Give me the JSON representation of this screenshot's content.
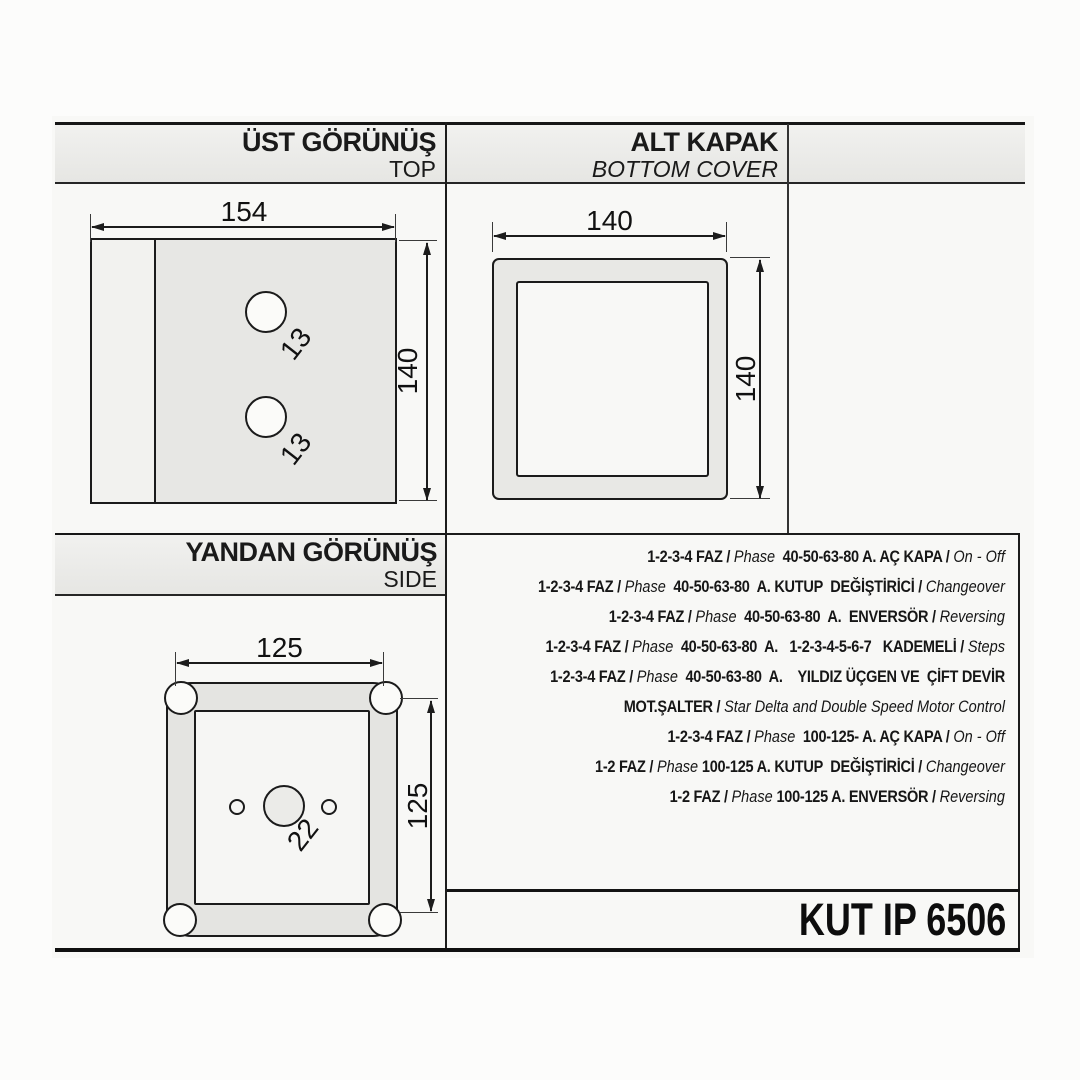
{
  "colors": {
    "ink": "#1c1c1c",
    "paper": "#f8f8f6",
    "band_fill": "#e9e9e6"
  },
  "top_view": {
    "title": "ÜST GÖRÜNÜŞ",
    "subtitle": "TOP",
    "width_dim": "154",
    "height_dim": "140",
    "hole_top_dim": "13",
    "hole_bottom_dim": "13"
  },
  "bottom_cover": {
    "title": "ALT KAPAK",
    "subtitle": "BOTTOM COVER",
    "width_dim": "140",
    "height_dim": "140"
  },
  "side_view": {
    "title": "YANDAN GÖRÜNÜŞ",
    "subtitle": "SIDE",
    "width_dim": "125",
    "height_dim": "125",
    "hole_dim": "22"
  },
  "spec_lines": [
    [
      {
        "t": "1-2-3-4 FAZ / ",
        "s": "b"
      },
      {
        "t": "Phase",
        "s": "i"
      },
      {
        "t": "  40-50-63-80 A. AÇ KAPA / ",
        "s": "b"
      },
      {
        "t": "On - Off",
        "s": "i"
      }
    ],
    [
      {
        "t": "1-2-3-4 FAZ / ",
        "s": "b"
      },
      {
        "t": "Phase",
        "s": "i"
      },
      {
        "t": "  40-50-63-80  A. KUTUP  DEĞİŞTİRİCİ / ",
        "s": "b"
      },
      {
        "t": "Changeover",
        "s": "i"
      }
    ],
    [
      {
        "t": "1-2-3-4 FAZ / ",
        "s": "b"
      },
      {
        "t": "Phase",
        "s": "i"
      },
      {
        "t": "  40-50-63-80  A.  ENVERSÖR / ",
        "s": "b"
      },
      {
        "t": "Reversing",
        "s": "i"
      }
    ],
    [
      {
        "t": "1-2-3-4 FAZ / ",
        "s": "b"
      },
      {
        "t": "Phase",
        "s": "i"
      },
      {
        "t": "  40-50-63-80  A.   1-2-3-4-5-6-7   KADEMELİ / ",
        "s": "b"
      },
      {
        "t": "Steps",
        "s": "i"
      }
    ],
    [
      {
        "t": "1-2-3-4 FAZ / ",
        "s": "b"
      },
      {
        "t": "Phase",
        "s": "i"
      },
      {
        "t": "  40-50-63-80  A.    YILDIZ ÜÇGEN VE  ÇİFT DEVİR",
        "s": "b"
      }
    ],
    [
      {
        "t": "MOT.ŞALTER / ",
        "s": "b"
      },
      {
        "t": "Star Delta and Double Speed Motor Control",
        "s": "i"
      }
    ],
    [
      {
        "t": "1-2-3-4 FAZ / ",
        "s": "b"
      },
      {
        "t": "Phase",
        "s": "i"
      },
      {
        "t": "  100-125- A. AÇ KAPA / ",
        "s": "b"
      },
      {
        "t": "On - Off",
        "s": "i"
      }
    ],
    [
      {
        "t": "1-2 FAZ / ",
        "s": "b"
      },
      {
        "t": "Phase",
        "s": "i"
      },
      {
        "t": " 100-125 A. KUTUP  DEĞİŞTİRİCİ / ",
        "s": "b"
      },
      {
        "t": "Changeover",
        "s": "i"
      }
    ],
    [
      {
        "t": "1-2 FAZ / ",
        "s": "b"
      },
      {
        "t": "Phase",
        "s": "i"
      },
      {
        "t": " 100-125 A. ENVERSÖR / ",
        "s": "b"
      },
      {
        "t": "Reversing",
        "s": "i"
      }
    ]
  ],
  "model": "KUT IP 6506"
}
